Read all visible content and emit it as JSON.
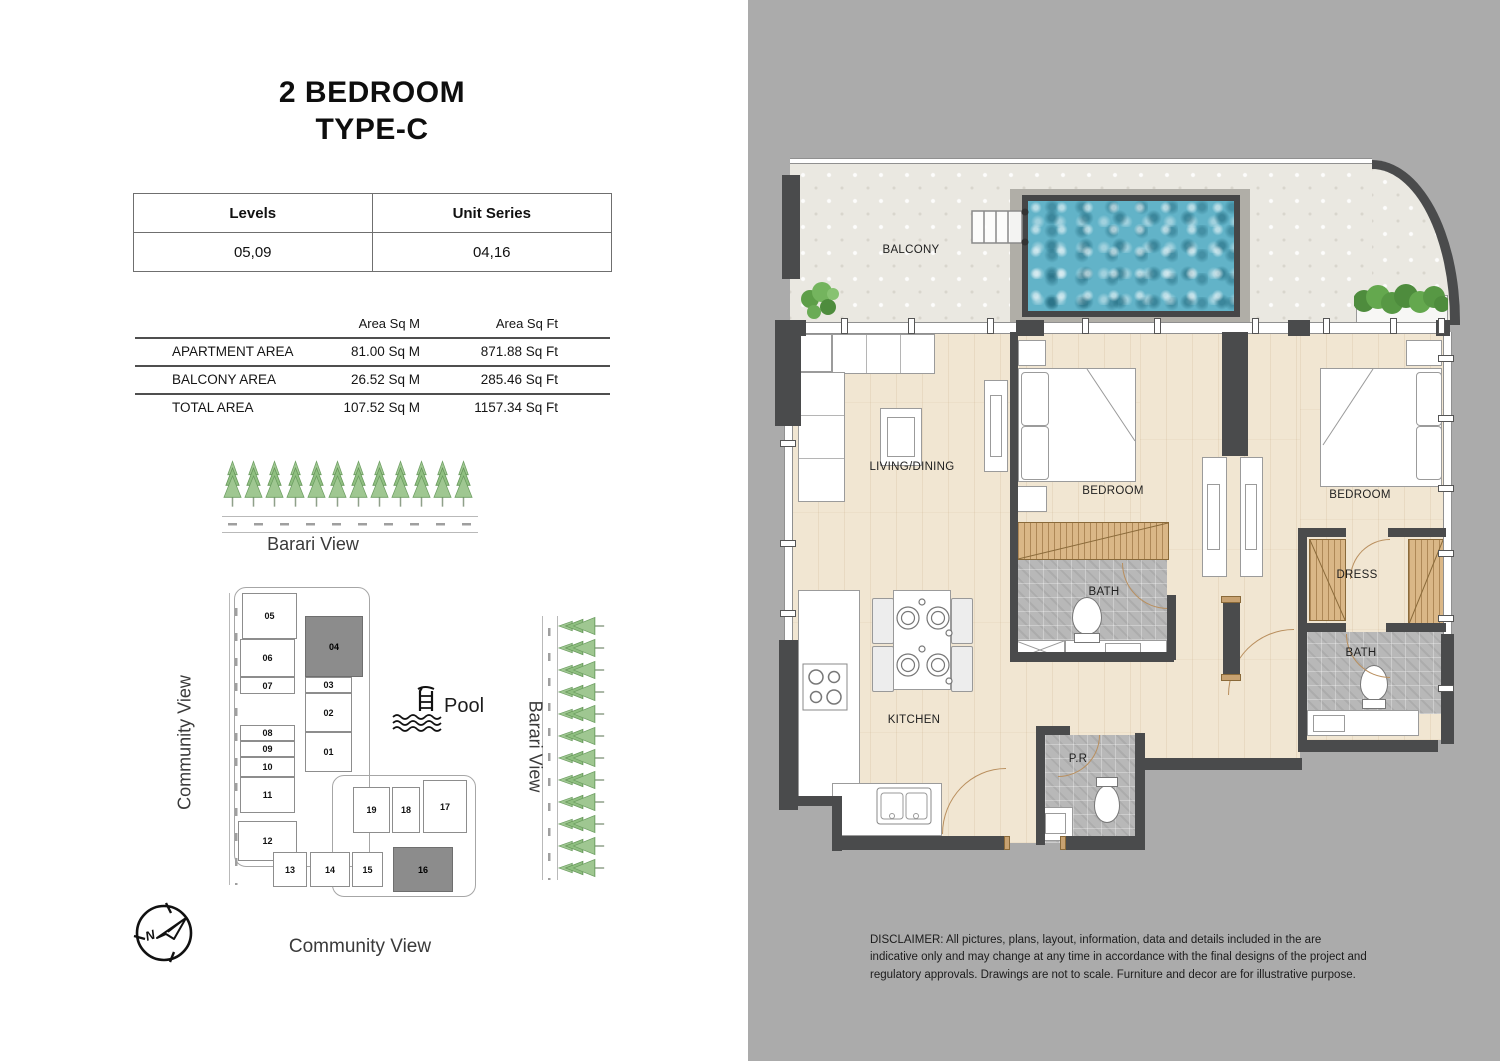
{
  "header": {
    "title_line1": "2 BEDROOM",
    "title_line2": "TYPE-C"
  },
  "levels_table": {
    "col1_header": "Levels",
    "col2_header": "Unit Series",
    "col1_value": "05,09",
    "col2_value": "04,16"
  },
  "area_table": {
    "sqm_header": "Area Sq M",
    "sqft_header": "Area Sq Ft",
    "rows": [
      {
        "label": "APARTMENT AREA",
        "sqm": "81.00 Sq M",
        "sqft": "871.88 Sq Ft"
      },
      {
        "label": "BALCONY AREA",
        "sqm": "26.52 Sq M",
        "sqft": "285.46 Sq Ft"
      },
      {
        "label": "TOTAL AREA",
        "sqm": "107.52 Sq M",
        "sqft": "1157.34 Sq Ft"
      }
    ]
  },
  "views": {
    "top_label": "Barari View",
    "left_label": "Community View",
    "right_label": "Barari View",
    "bottom_label": "Community View"
  },
  "key_plan": {
    "pool_label": "Pool",
    "highlighted_units": [
      "04",
      "16"
    ],
    "units": [
      {
        "label": "05"
      },
      {
        "label": "06"
      },
      {
        "label": "07"
      },
      {
        "label": "08"
      },
      {
        "label": "09"
      },
      {
        "label": "10"
      },
      {
        "label": "11"
      },
      {
        "label": "12"
      },
      {
        "label": "04",
        "highlighted": true
      },
      {
        "label": "03"
      },
      {
        "label": "02"
      },
      {
        "label": "01"
      },
      {
        "label": "19"
      },
      {
        "label": "18"
      },
      {
        "label": "17"
      },
      {
        "label": "13"
      },
      {
        "label": "14"
      },
      {
        "label": "15"
      },
      {
        "label": "16",
        "highlighted": true
      }
    ]
  },
  "floor_plan": {
    "balcony": "BALCONY",
    "living": "LIVING/DINING",
    "bedroom1": "BEDROOM",
    "bedroom2": "BEDROOM",
    "bath1": "BATH",
    "bath2": "BATH",
    "dress": "DRESS",
    "kitchen": "KITCHEN",
    "powder": "P.R"
  },
  "disclaimer": "DISCLAIMER: All pictures, plans, layout, information, data and details included in the are indicative only and may change at any time in accordance with the final designs of the project and regulatory approvals. Drawings are not to scale. Furniture and decor are for illustrative purpose.",
  "colors": {
    "panel_bg": "#ababab",
    "wall": "#4a4b4c",
    "pool_water": "#62b3c8",
    "wood_floor": "#f1e6d2",
    "tile_gray": "#b8b8b8",
    "wood_hatch": "#dab787",
    "highlight_unit": "#8c8c8c",
    "tree_green": "#8fbf80"
  }
}
